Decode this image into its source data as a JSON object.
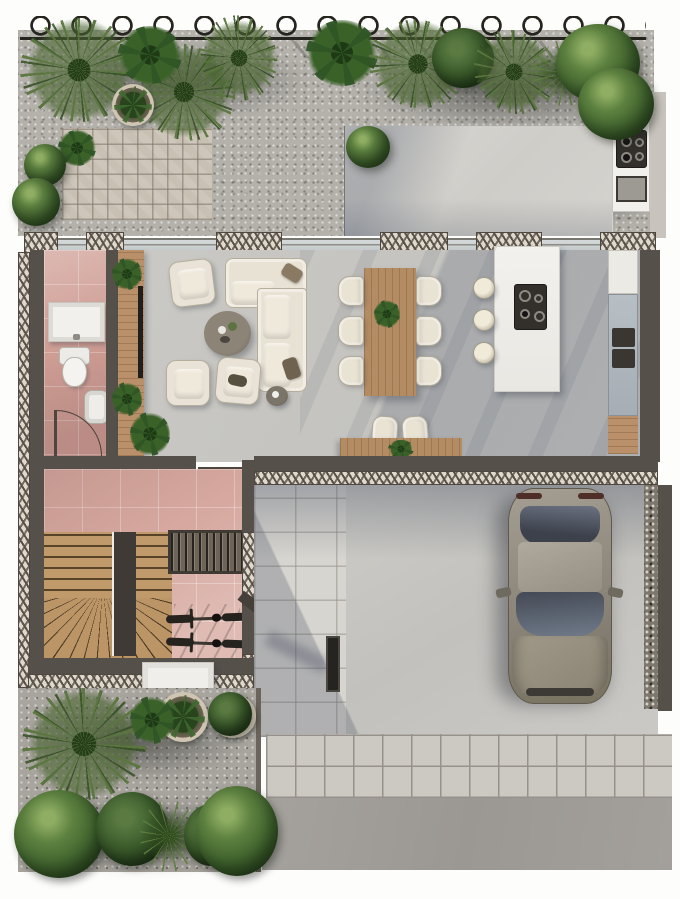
{
  "scene": {
    "title": "top-down architectural floor plan rendering of a narrow house lot",
    "style": "photorealistic color render, no text labels visible",
    "rooms": [
      {
        "name": "back-garden",
        "features": [
          "gravel ground",
          "herringbone brick patio",
          "palms, yucca and round shrubs along looped wire fence",
          "potted plant",
          "concrete terrace",
          "outdoor kitchen counter with cooktop and grill"
        ]
      },
      {
        "name": "living-room",
        "features": [
          "L-shaped cream sectional sofa with two throw pillows",
          "three cream armchairs",
          "round dark coffee table with cups",
          "small round side table",
          "wood media console with TV bar and two plants",
          "floor plant"
        ]
      },
      {
        "name": "dining-area",
        "features": [
          "rectangular wood table",
          "six cream chairs",
          "green plant centerpiece"
        ]
      },
      {
        "name": "kitchen",
        "features": [
          "white stone island with dark induction cooktop",
          "three round cream stools",
          "tall wall units with built-in appliances and two dark handles"
        ]
      },
      {
        "name": "study-nook",
        "features": [
          "wood desk against wall",
          "two cream chairs",
          "small desk plant"
        ]
      },
      {
        "name": "bathroom",
        "features": [
          "pink tile floor",
          "white vanity sink",
          "wall-hung toilet",
          "small bidet fixture",
          "swing door arc"
        ]
      },
      {
        "name": "hallway",
        "features": [
          "pink tile floor",
          "U-shaped timber stair with fan winders and dark center stringer",
          "wardrobe with hanging clothes",
          "two bicycles parked",
          "entry door arc",
          "white doormat outside"
        ]
      },
      {
        "name": "driveway-carport",
        "features": [
          "gray sedan parked nose-down",
          "concrete court",
          "dark bollard pillar",
          "pebble strip along right boundary wall"
        ]
      },
      {
        "name": "front-garden",
        "features": [
          "dark gravel",
          "large palm",
          "two round potted plants",
          "row of five round shrubs and a spiky plant"
        ]
      },
      {
        "name": "street-edge",
        "features": [
          "paver apron band of upright rectangles",
          "gray concrete sidewalk",
          "large-format paved walkway to the entry"
        ]
      }
    ],
    "counts": {
      "dining_chairs": 6,
      "island_stools": 3,
      "armchairs": 3,
      "bicycles": 2,
      "potted_plants": 3,
      "cars": 1,
      "door_arcs": 3,
      "fence_loops": 15
    },
    "palette": {
      "background": "#ffffff",
      "gravel": "#b4b1ab",
      "front_gravel": "#a8a49e",
      "interior_floor": "#c8c7c3",
      "patio_concrete": "#d6d4cf",
      "hall_pink": "#d6a89f",
      "bathroom_pink": "#cf9e95",
      "wall_dark": "#56504a",
      "wood": "#b9906a",
      "sofa_cream": "#e8e2d4",
      "island_white": "#f1efeb",
      "glass_blue": "#ccd1d3",
      "shadow_blue": "#4b556a",
      "plant_green": "#597a40",
      "plant_dark_green": "#32501f",
      "car_gray": "#8d8679",
      "paver": "#ccc9c3",
      "sidewalk": "#a19e99"
    }
  }
}
